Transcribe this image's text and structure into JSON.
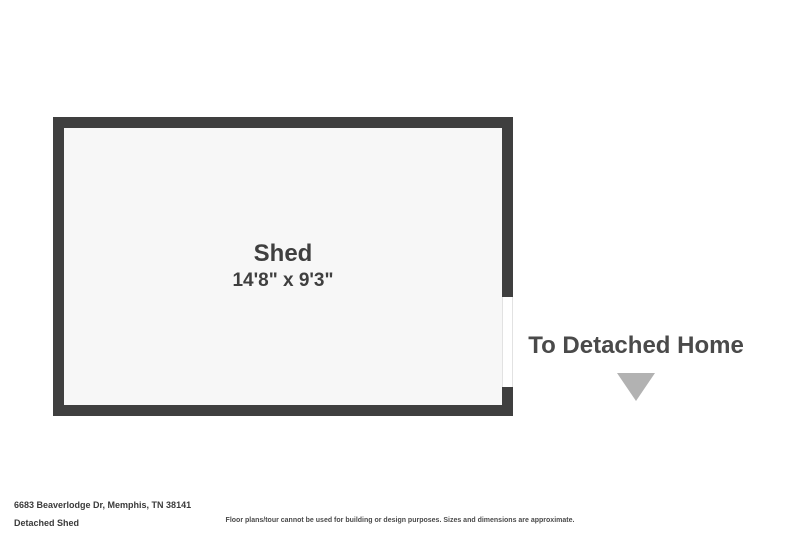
{
  "floorplan": {
    "room": {
      "name": "Shed",
      "dimensions": "14'8\" x 9'3\""
    },
    "door_opening": "right-wall",
    "colors": {
      "wall": "#3f3f3f",
      "interior": "#f7f7f7",
      "opening": "#ffffff",
      "label_text": "#3f3f3f"
    }
  },
  "annotation": {
    "label": "To Detached Home",
    "arrow_icon": "triangle-down-icon",
    "arrow_color": "#b2b2b2"
  },
  "footer": {
    "address": "6683 Beaverlodge Dr, Memphis, TN 38141",
    "plan_title": "Detached Shed",
    "disclaimer": "Floor plans/tour cannot be used for building or design purposes. Sizes and dimensions are approximate."
  }
}
